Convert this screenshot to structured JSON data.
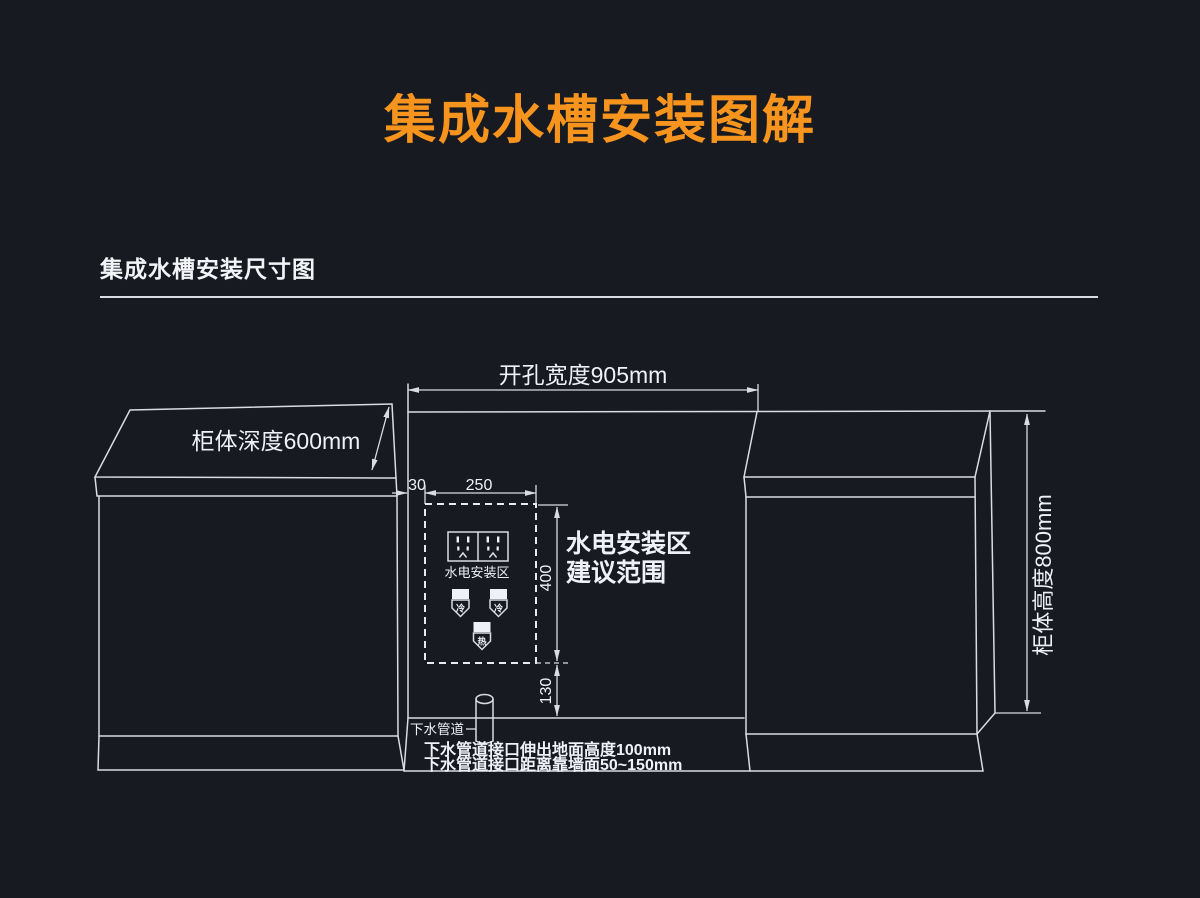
{
  "page": {
    "title": "集成水槽安装图解",
    "section_title": "集成水槽安装尺寸图"
  },
  "colors": {
    "background": "#171a21",
    "accent_orange": "#f7941e",
    "line": "#d9dde2",
    "text": "#eef1f5"
  },
  "diagram": {
    "dimensions": {
      "opening_width": "开孔宽度905mm",
      "cabinet_depth": "柜体深度600mm",
      "cabinet_height": "柜体高度800mm",
      "offset_left": "30",
      "zone_width": "250",
      "zone_height": "400",
      "zone_bottom_gap": "130"
    },
    "labels": {
      "outlet_zone": "水电安装区",
      "zone_note_line1": "水电安装区",
      "zone_note_line2": "建议范围",
      "cold_valve": "冷",
      "hot_valve": "热",
      "drain_pipe": "下水管道",
      "drain_note1": "下水管道接口伸出地面高度100mm",
      "drain_note2": "下水管道接口距离靠墙面50~150mm"
    },
    "icons": {
      "sockets": "power-socket-icon",
      "cold": "cold-water-valve-icon",
      "hot": "hot-water-valve-icon",
      "pipe": "drain-pipe-icon"
    }
  }
}
